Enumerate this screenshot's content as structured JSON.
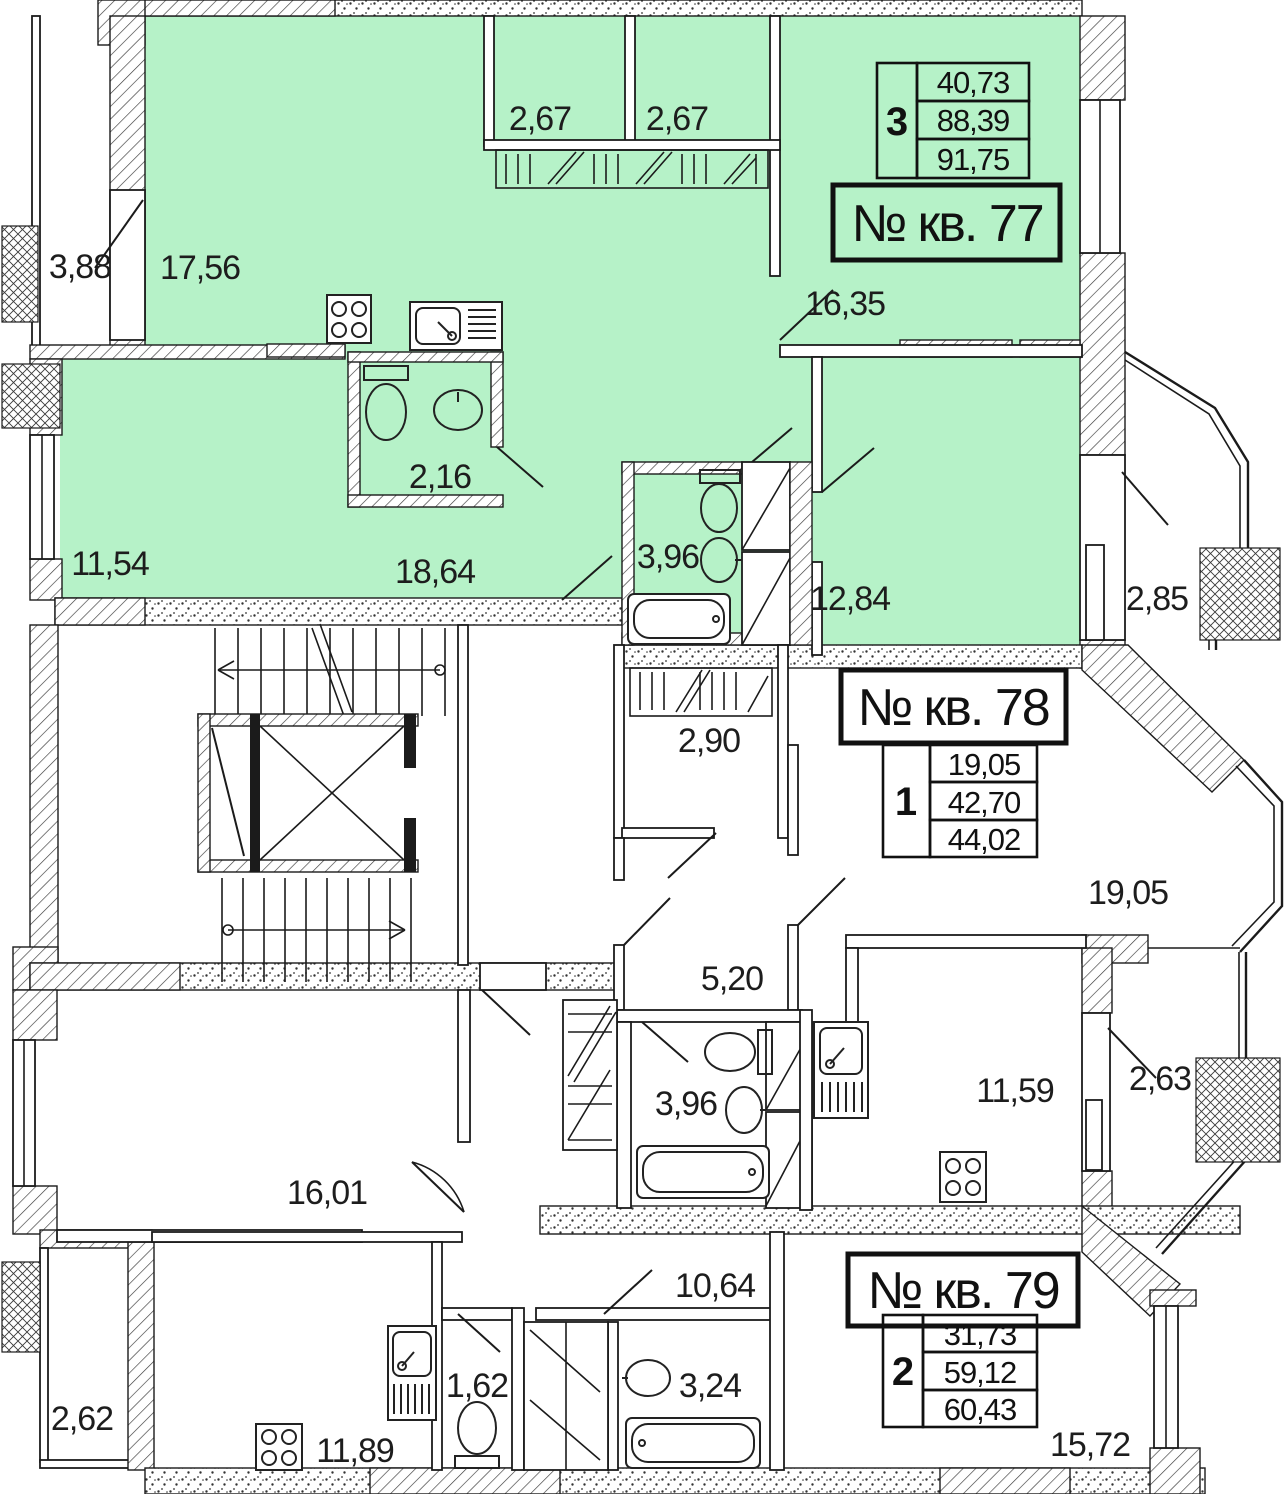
{
  "plan": {
    "colors": {
      "highlight_fill": "#b6f2c8",
      "wall_line": "#1b1b1b",
      "background": "#ffffff"
    },
    "apartments": [
      {
        "id": "77",
        "number_label": "№ кв. 77",
        "rooms_count": "3",
        "areas": {
          "living": "40,73",
          "total": "88,39",
          "total_with_balcony": "91,75"
        },
        "rooms": {
          "balcony_left": "3,88",
          "kitchen_living": "17,56",
          "closet_1": "2,67",
          "closet_2": "2,67",
          "bedroom_right": "16,35",
          "wc": "2,16",
          "bedroom_left": "11,54",
          "hall": "18,64",
          "bathroom": "3,96",
          "bedroom_bottom": "12,84",
          "balcony_right": "2,85"
        }
      },
      {
        "id": "78",
        "number_label": "№ кв. 78",
        "rooms_count": "1",
        "areas": {
          "living": "19,05",
          "total": "42,70",
          "total_with_balcony": "44,02"
        },
        "rooms": {
          "hall": "2,90",
          "living": "19,05",
          "corridor": "5,20",
          "bathroom": "3,96",
          "kitchen": "11,59",
          "balcony": "2,63"
        }
      },
      {
        "id": "79",
        "number_label": "№ кв. 79",
        "rooms_count": "2",
        "areas": {
          "living": "31,73",
          "total": "59,12",
          "total_with_balcony": "60,43"
        },
        "rooms": {
          "living": "16,01",
          "hall": "10,64",
          "wc": "1,62",
          "bathroom": "3,24",
          "kitchen": "11,89",
          "bedroom": "15,72",
          "balcony": "2,62"
        }
      }
    ]
  }
}
